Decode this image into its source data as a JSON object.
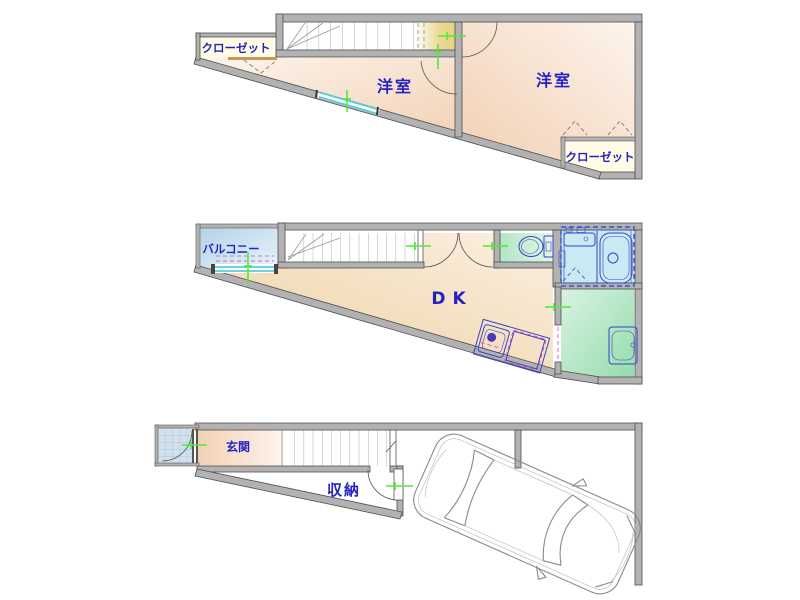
{
  "labels": {
    "f3_room_left": "洋室",
    "f3_room_right": "洋室",
    "f3_closet_left": "クローゼット",
    "f3_closet_right": "クローゼット",
    "f2_balcony": "バルコニー",
    "f2_dk": "DK",
    "f1_entrance": "玄関",
    "f1_storage": "収納"
  },
  "colors": {
    "wall_fill": "#b2b2b2",
    "wall_edge": "#4f4f4f",
    "label_text": "#2323c3",
    "room_peach": "#f3d2b6",
    "dk_tan": "#eed0a0",
    "closet_cream": "#fffbe4",
    "landing_yellow": "#e7d385",
    "balcony_blue": "#b4d2e6",
    "bath_blue": "#c9e9f3",
    "sanitary_green": "#94dcac",
    "window_cyan": "#55ccd8",
    "fixture_blue": "#3544c4",
    "mark_green": "#55e83c",
    "mark_magenta": "#e858c8"
  }
}
